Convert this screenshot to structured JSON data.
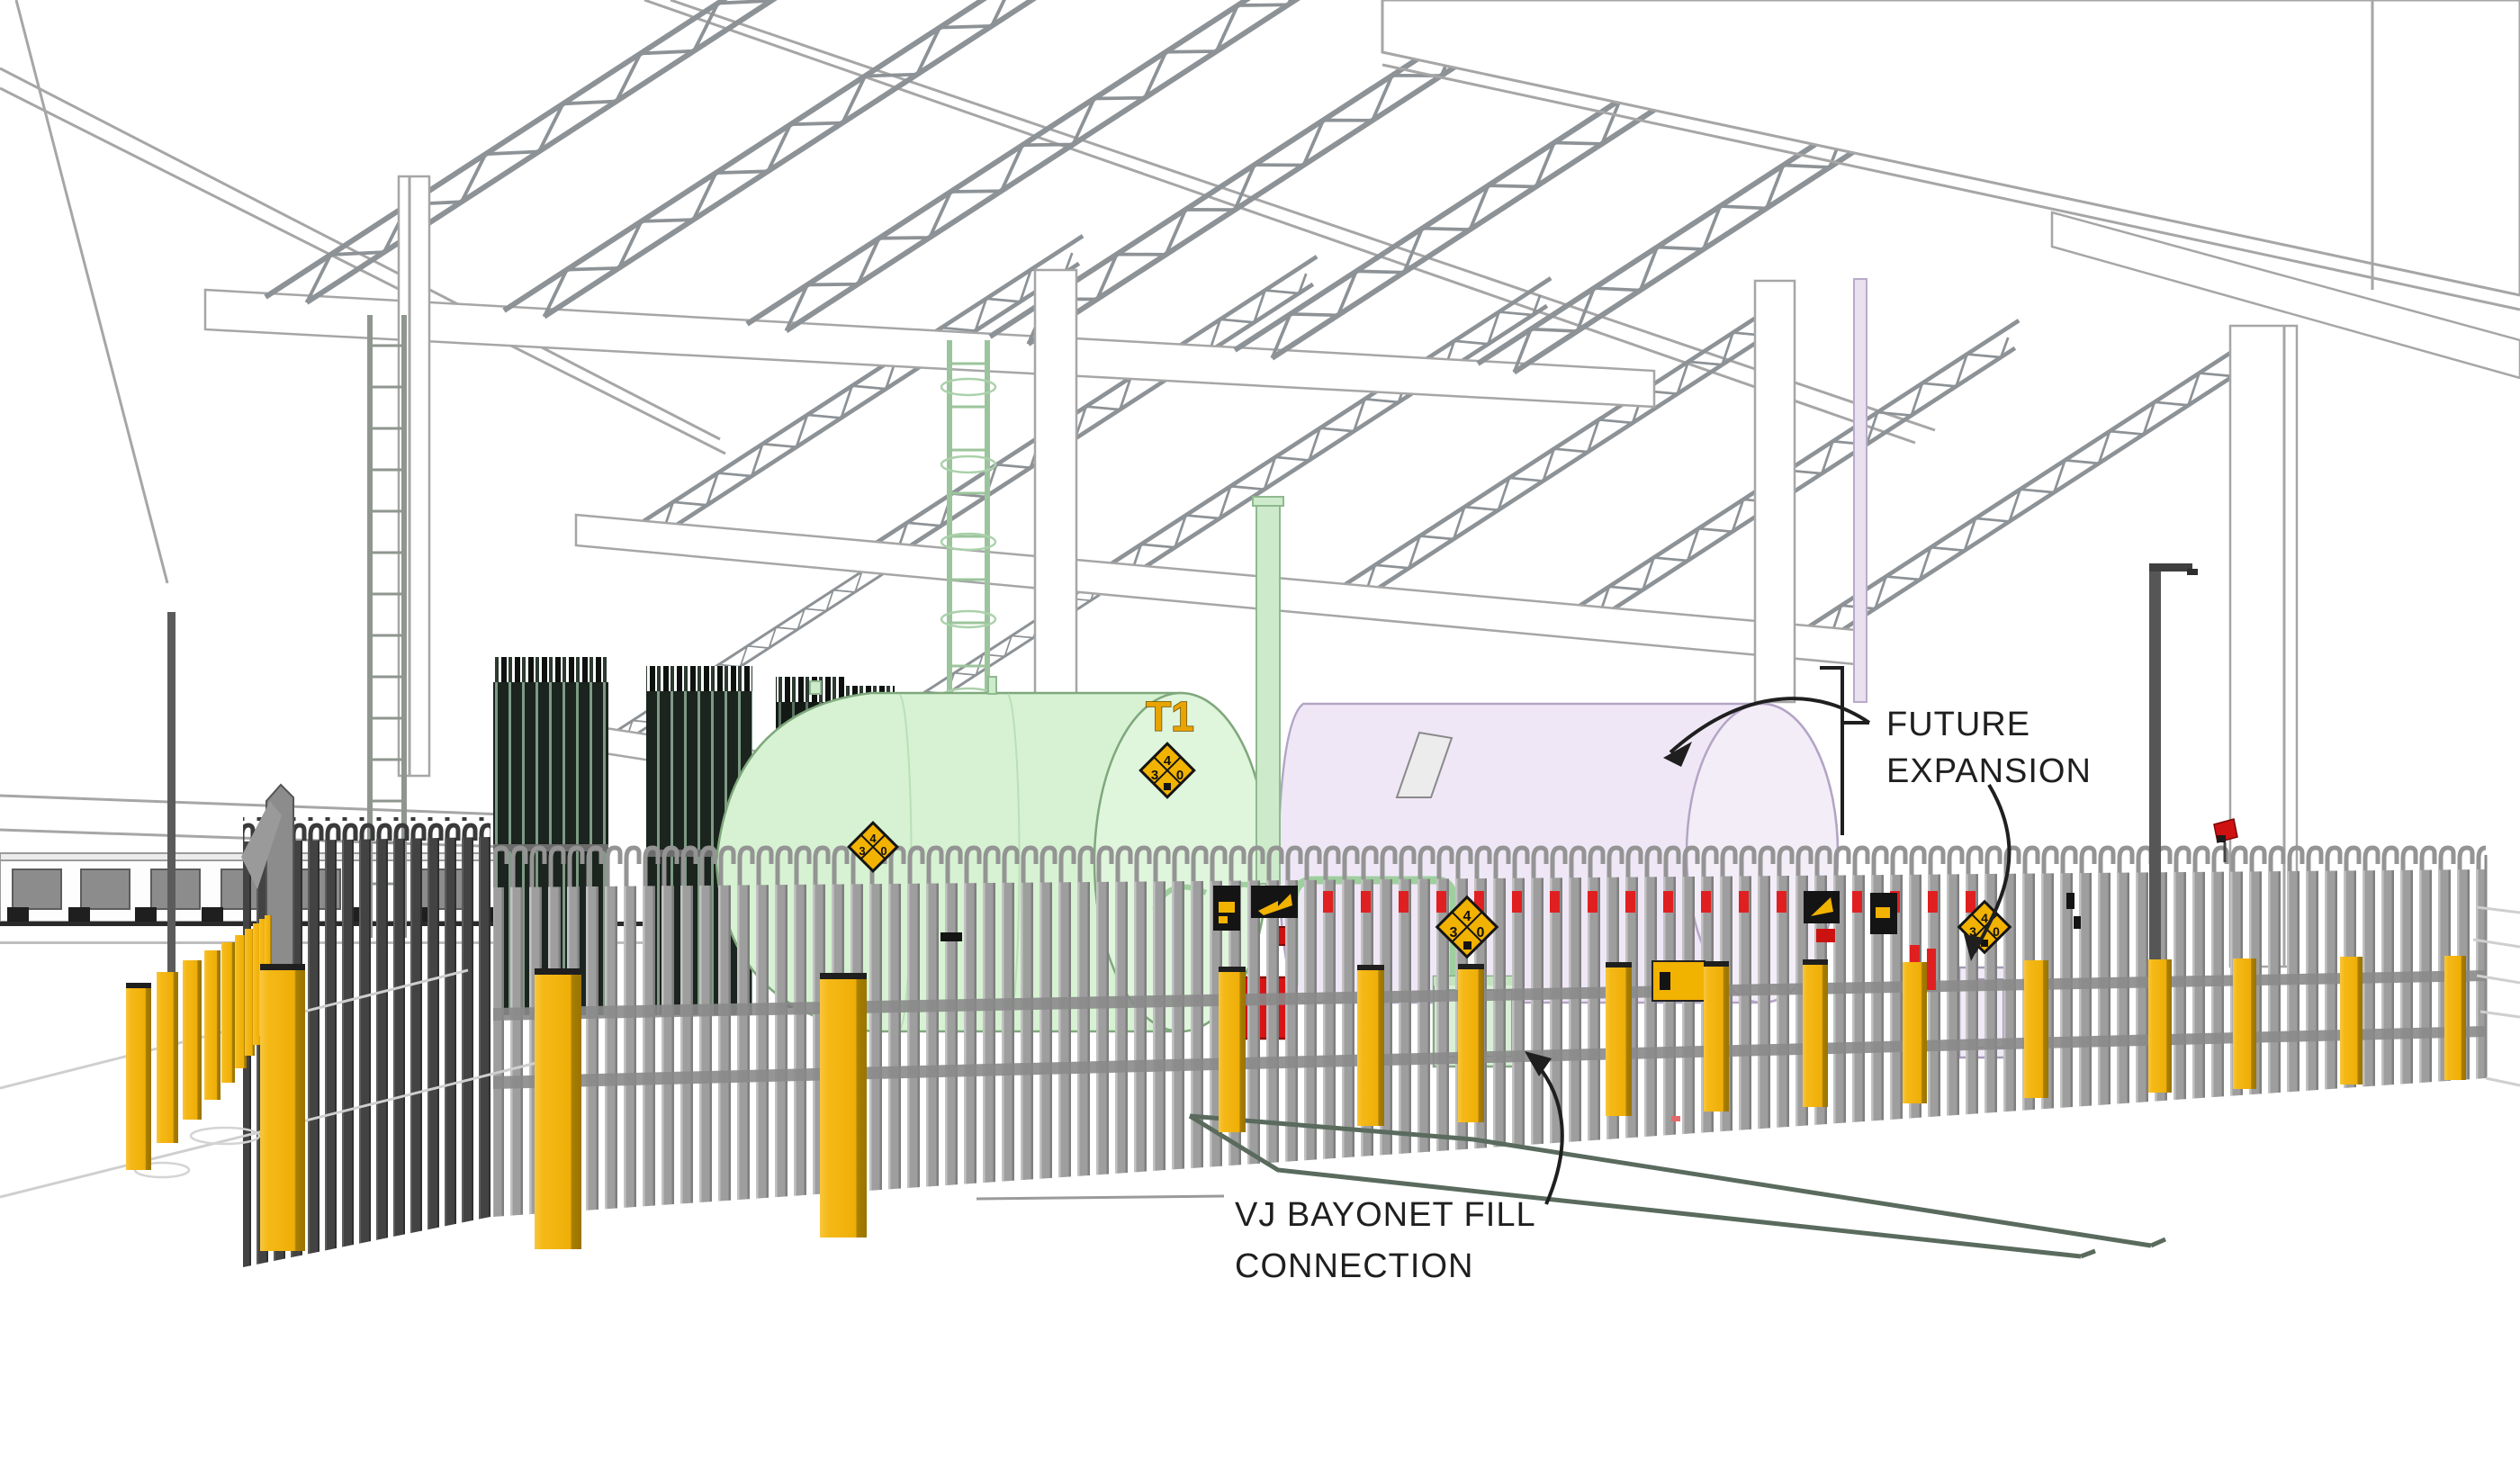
{
  "annotations": {
    "future_expansion": {
      "line1": "FUTURE",
      "line2": "EXPANSION"
    },
    "vj_bayonet_fill": {
      "line1": "VJ BAYONET FILL",
      "line2": "CONNECTION"
    }
  },
  "tank": {
    "label": "T1"
  },
  "nfpa_diamond": {
    "flammability": "4",
    "health": "3",
    "instability": "0"
  },
  "colors": {
    "background": "#FFFFFF",
    "bollard_yellow": "#F5B917",
    "bollard_shade": "#A87E00",
    "hazard_yellow": "#F2B200",
    "alarm_red": "#D81414",
    "safety_dash_red": "#E02020",
    "tank_green": "#D6F2D2",
    "tank_green_head": "#DFF5DC",
    "tank_lavender": "#EFE7F6",
    "tank_lavender_head": "#F3EDF8",
    "vent_green": "#CDEBCB",
    "fence_gray": "#9E9E9E",
    "fence_dark_gray": "#434343",
    "rail_gray": "#8A8A8A",
    "structure_line_gray": "#A6A6A6",
    "truss_gray": "#8D9296",
    "vaporizer_dark": "#1B241E",
    "vaporizer_stripe": "#7D9A85",
    "trench_green": "#5A6B5E",
    "ink": "#1F1F1F"
  }
}
